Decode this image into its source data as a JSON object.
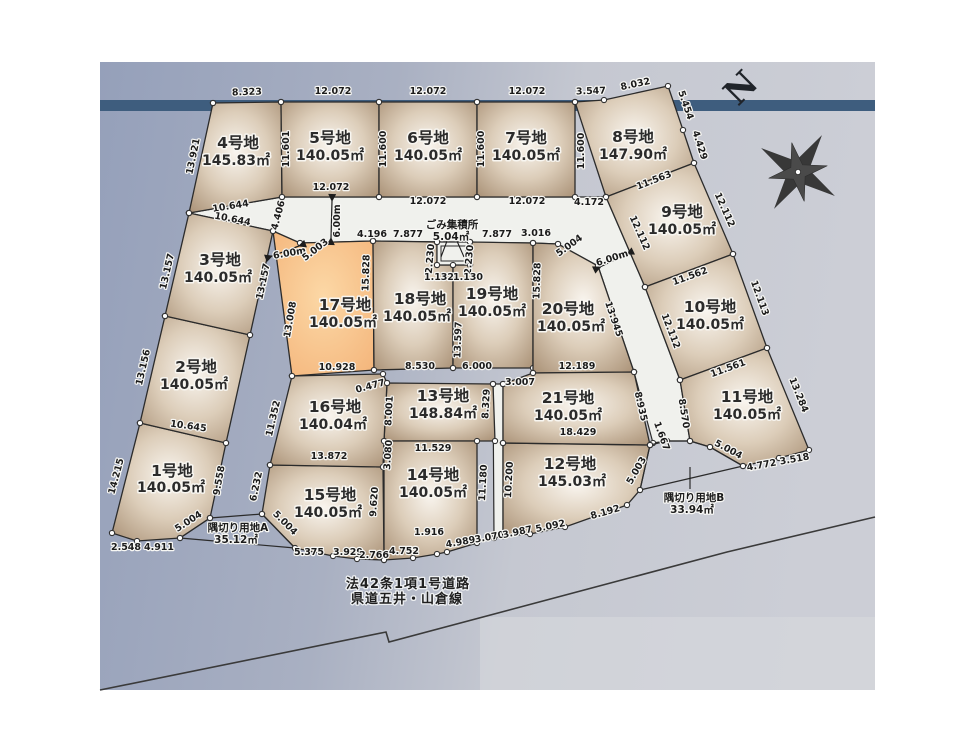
{
  "lots": [
    {
      "name": "1号地",
      "area": "140.05㎡"
    },
    {
      "name": "2号地",
      "area": "140.05㎡"
    },
    {
      "name": "3号地",
      "area": "140.05㎡"
    },
    {
      "name": "4号地",
      "area": "145.83㎡"
    },
    {
      "name": "5号地",
      "area": "140.05㎡"
    },
    {
      "name": "6号地",
      "area": "140.05㎡"
    },
    {
      "name": "7号地",
      "area": "140.05㎡"
    },
    {
      "name": "8号地",
      "area": "147.90㎡"
    },
    {
      "name": "9号地",
      "area": "140.05㎡"
    },
    {
      "name": "10号地",
      "area": "140.05㎡"
    },
    {
      "name": "11号地",
      "area": "140.05㎡"
    },
    {
      "name": "12号地",
      "area": "145.03㎡"
    },
    {
      "name": "13号地",
      "area": "148.84㎡"
    },
    {
      "name": "14号地",
      "area": "140.05㎡"
    },
    {
      "name": "15号地",
      "area": "140.05㎡"
    },
    {
      "name": "16号地",
      "area": "140.04㎡"
    },
    {
      "name": "17号地",
      "area": "140.05㎡"
    },
    {
      "name": "18号地",
      "area": "140.05㎡"
    },
    {
      "name": "19号地",
      "area": "140.05㎡"
    },
    {
      "name": "20号地",
      "area": "140.05㎡"
    },
    {
      "name": "21号地",
      "area": "140.05㎡"
    }
  ],
  "dims": [
    "8.323",
    "12.072",
    "12.072",
    "12.072",
    "3.547",
    "8.032",
    "5.454",
    "4.429",
    "13.921",
    "11.601",
    "11.600",
    "11.600",
    "11.600",
    "10.644",
    "12.072",
    "12.072",
    "12.072",
    "4.172",
    "11.563",
    "4.406",
    "10.644",
    "6.00m",
    "5.003",
    "6.00m",
    "4.196",
    "7.877",
    "7.877",
    "3.016",
    "5.004",
    "6.00m",
    "12.112",
    "12.112",
    "2.230",
    "2.230",
    "1.132",
    "1.130",
    "13.157",
    "13.157",
    "13.008",
    "15.828",
    "15.828",
    "13.945",
    "11.562",
    "12.112",
    "12.113",
    "13.597",
    "10.928",
    "8.530",
    "6.000",
    "12.189",
    "13.156",
    "10.645",
    "0.477",
    "3.007",
    "11.561",
    "8.935",
    "8.570",
    "13.284",
    "11.352",
    "8.001",
    "8.329",
    "18.429",
    "13.872",
    "3.080",
    "11.529",
    "1.667",
    "5.004",
    "14.215",
    "9.558",
    "6.232",
    "11.180",
    "10.200",
    "4.772",
    "3.518",
    "5.003",
    "5.004",
    "5.004",
    "2.548",
    "4.911",
    "1.916",
    "9.620",
    "5.375",
    "3.929",
    "2.766",
    "4.752",
    "4.989",
    "3.070",
    "3.987",
    "5.092",
    "8.192"
  ],
  "special": {
    "gomi": {
      "label": "ごみ集積所",
      "area": "5.04㎡"
    },
    "sumikiri_a": {
      "label": "隅切り用地A",
      "area": "35.12㎡"
    },
    "sumikiri_b": {
      "label": "隅切り用地B",
      "area": "33.94㎡"
    }
  },
  "road": {
    "line1": "法42条1項1号道路",
    "line2": "県道五井・山倉線"
  },
  "compass": {
    "label": "N"
  },
  "colors": {
    "lot_fill": "#a1876b",
    "lot_highlight": "#f6ba7d",
    "band": "#3e5d7e",
    "bg_left": "#95a0ba",
    "bg_right": "#ccced6",
    "road_fill": "#f0f1ed"
  }
}
